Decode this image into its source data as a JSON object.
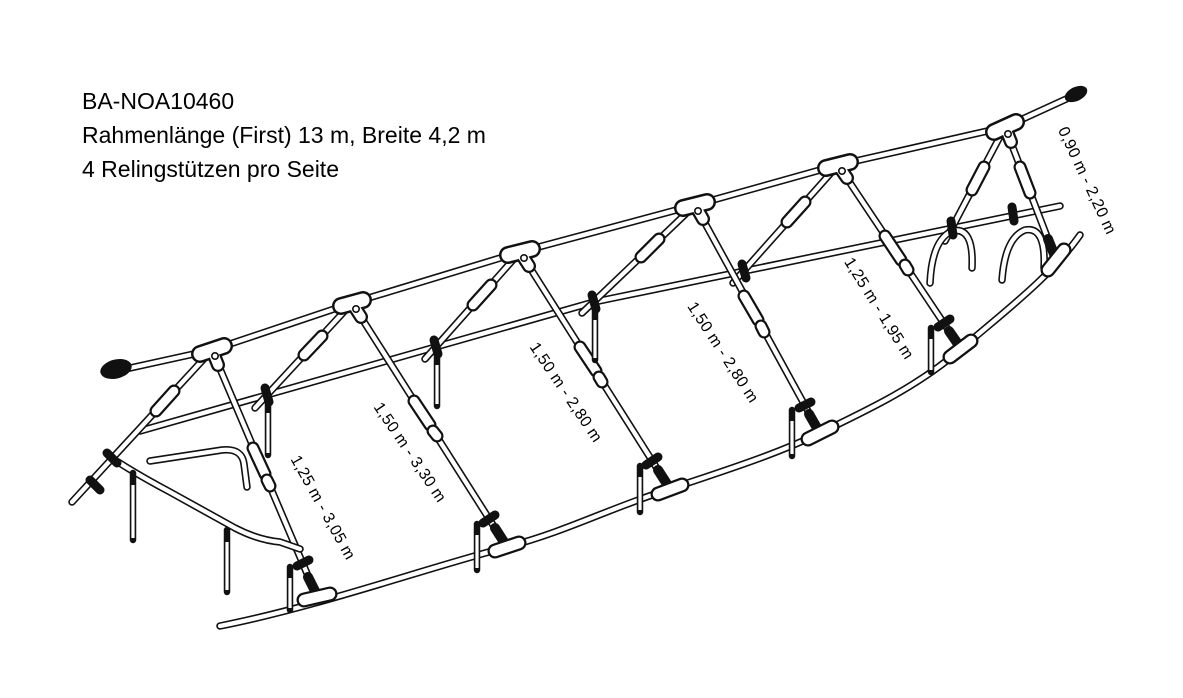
{
  "colors": {
    "background": "#ffffff",
    "line": "#111111",
    "text": "#000000"
  },
  "header": {
    "product_code": "BA-NOA10460",
    "dimensions_line": "Rahmenlänge (First) 13 m, Breite 4,2 m",
    "supports_line": "4 Relingstützen pro Seite"
  },
  "measurements": [
    {
      "text": "1,25 m - 3,05 m"
    },
    {
      "text": "1,50 m - 3,30 m"
    },
    {
      "text": "1,50 m - 2,80 m"
    },
    {
      "text": "1,50 m - 2,80 m"
    },
    {
      "text": "1,25 m - 1,95 m"
    },
    {
      "text": "0,90 m - 2,20 m"
    }
  ]
}
